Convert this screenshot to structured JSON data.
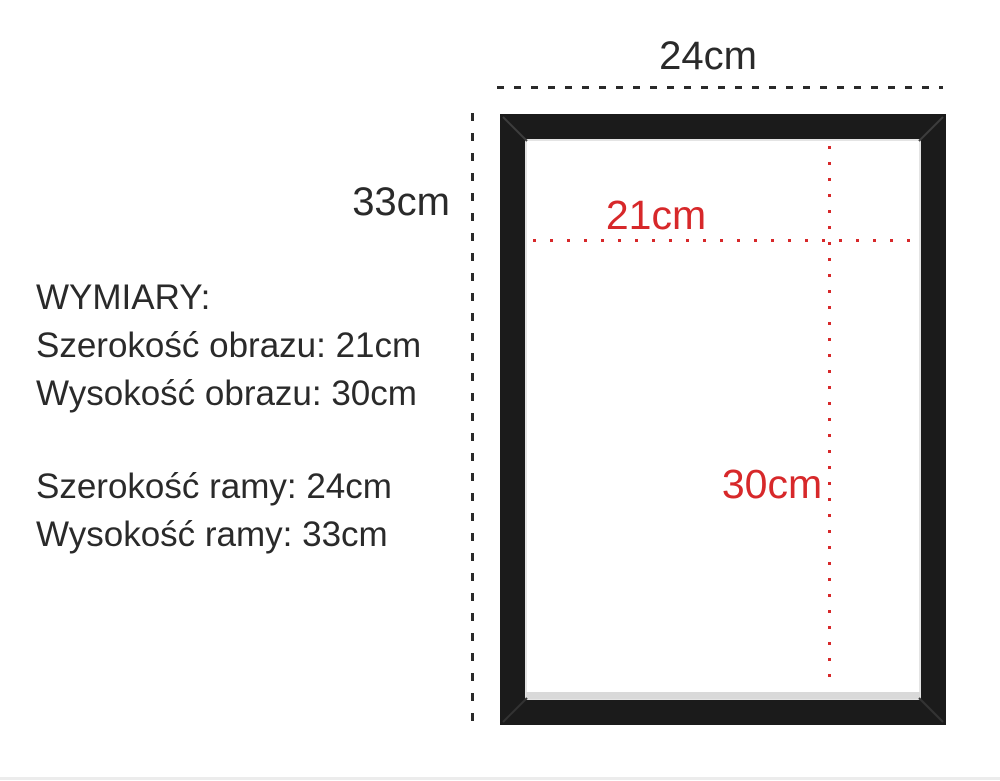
{
  "labels": {
    "frame_width": "24cm",
    "frame_height": "33cm",
    "picture_width": "21cm",
    "picture_height": "30cm"
  },
  "specs": {
    "title": "WYMIARY:",
    "lines": [
      "Szerokość obrazu: 21cm",
      "Wysokość obrazu: 30cm",
      "",
      "Szerokość ramy: 24cm",
      "Wysokość ramy: 33cm"
    ]
  },
  "colors": {
    "ink": "#2a2a2a",
    "accent_red": "#d7282a",
    "frame_black": "#1b1b1b"
  }
}
